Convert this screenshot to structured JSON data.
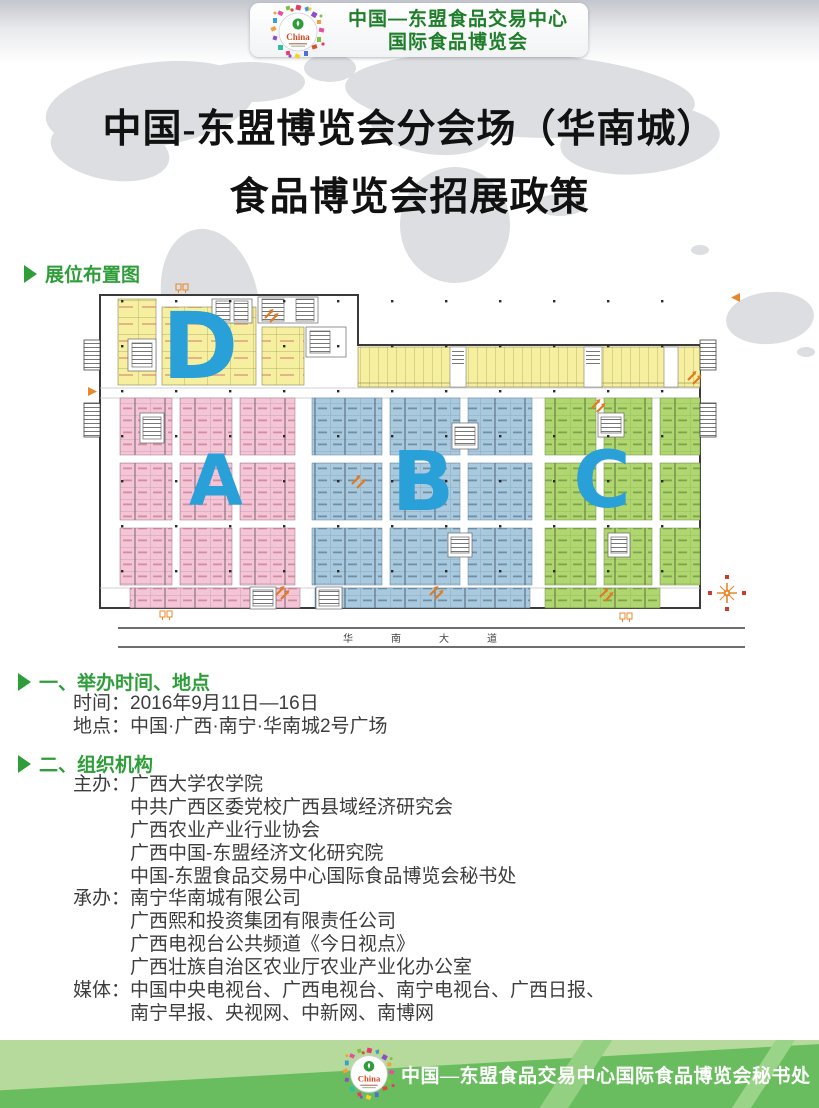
{
  "header": {
    "logo_text": "China",
    "org_name_line1": "中国—东盟食品交易中心",
    "org_name_line2": "国际食品博览会"
  },
  "title": {
    "line1": "中国-东盟博览会分会场（华南城）",
    "line2": "食品博览会招展政策"
  },
  "floor_plan": {
    "section_label": "展位布置图",
    "road_label": "华南大道",
    "letter_color": "#29a0d8",
    "zones": [
      {
        "letter": "D",
        "color": "#f6efa0"
      },
      {
        "letter": "A",
        "color": "#f4c5d6"
      },
      {
        "letter": "B",
        "color": "#a9c9de"
      },
      {
        "letter": "C",
        "color": "#b0d76f"
      }
    ]
  },
  "section1": {
    "heading": "一、举办时间、地点",
    "lines": [
      "时间：2016年9月11日—16日",
      "地点：中国·广西·南宁·华南城2号广场"
    ]
  },
  "section2": {
    "heading": "二、组织机构",
    "groups": [
      {
        "label": "主办：",
        "items": [
          "广西大学农学院",
          "中共广西区委党校广西县域经济研究会",
          "广西农业产业行业协会",
          "广西中国-东盟经济文化研究院",
          "中国-东盟食品交易中心国际食品博览会秘书处"
        ]
      },
      {
        "label": "承办：",
        "items": [
          "南宁华南城有限公司",
          "广西熙和投资集团有限责任公司",
          "广西电视台公共频道《今日视点》",
          "广西壮族自治区农业厅农业产业化办公室"
        ]
      },
      {
        "label": "媒体：",
        "items": [
          "中国中央电视台、广西电视台、南宁电视台、广西日报、",
          "南宁早报、央视网、中新网、南博网"
        ]
      }
    ]
  },
  "footer": {
    "secretariat": "中国—东盟食品交易中心国际食品博览会秘书处",
    "logo_text": "China"
  }
}
